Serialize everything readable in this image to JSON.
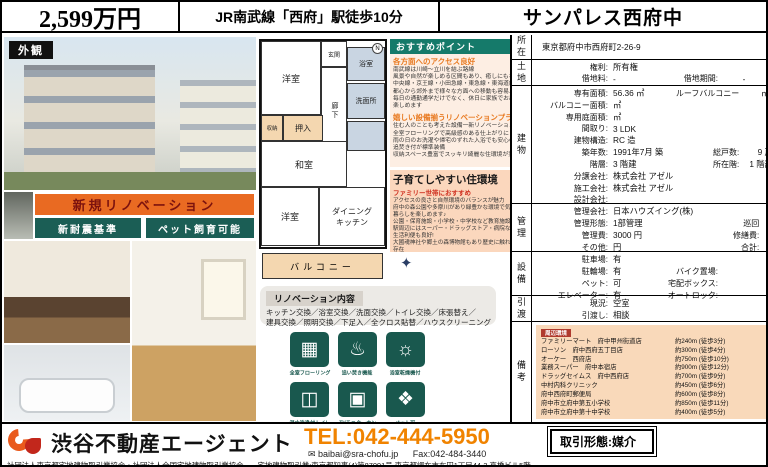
{
  "header": {
    "price": "2,599万円",
    "station": "JR南武線「西府」駅徒歩10分",
    "name": "サンパレス西府中"
  },
  "left": {
    "exterior_label": "外観",
    "banner": "新規リノベーション",
    "btn_seismic": "新耐震基準",
    "btn_pet": "ペット飼育可能"
  },
  "floorplan": {
    "genkan": "玄関",
    "room1": "洋室",
    "bath": "浴室",
    "hall": "廊下",
    "wash": "洗面所",
    "closet": "収納",
    "oshiire": "押入",
    "washitsu": "和室",
    "room2": "洋室",
    "dk1": "ダイニング",
    "dk2": "キッチン",
    "balcony": "バルコニー",
    "north": "N"
  },
  "points": {
    "title": "おすすめポイント",
    "s1_heading": "各方面へのアクセス良好",
    "s1_lines": [
      "南武線は川崎〜立川を結ぶ路線",
      "風景や自然が楽しめる区間もあり、癒しにもなります",
      "中央線・京王線・小田急線・東急線・東海道線と接続しており",
      "都心から郊外まで様々な方面への移動も容易♪",
      "毎日の通勤通学だけでなく、休日に家族でお出かけも",
      "楽しめます"
    ],
    "s2_heading": "嬉しい設備揃うリノベーションプラン",
    "s2_lines": [
      "住む人のことも考えた設備一新リノベーション",
      "全室フローリングで高級感のある仕上がりに",
      "雨の日のお洗濯や帰宅のずれた入浴でも安心の浴室乾燥・",
      "追焚き付が標準装備",
      "収納スペース豊富でスッキリ綺麗な住環境が実現可能"
    ]
  },
  "family": {
    "title": "子育てしやすい住環境",
    "subtitle": "ファミリー世帯におすすめ",
    "lines": [
      "アクセスの良さと自然環境のバランスが魅力",
      "府中の森公園や多摩川があり緑豊かな環境で気持ちの良い",
      "暮らしを楽しめます♪",
      "公園・保育施設・小学校・中学校など教育施設も充実",
      "駅周辺にはスーパー・ドラッグストア・病院などが揃っていて",
      "生活利便も良好!",
      "大國魂神社や郷土の森博物館もあり歴史に触れられるスポット",
      "存在",
      "再開発も進み更に住みやすくなるでしょう♪"
    ]
  },
  "renovation": {
    "title": "リノベーション内容",
    "line1": "キッチン交換／浴室交換／洗面交換／トイレ交換／床張替え／",
    "line2": "建具交換／照明交換／下足入／全クロス貼替／ハウスクリーニング"
  },
  "badges": {
    "items": [
      {
        "icon": "▦",
        "label": "全室フローリング"
      },
      {
        "icon": "♨",
        "label": "追い焚き機能"
      },
      {
        "icon": "☼",
        "label": "浴室乾燥機付"
      },
      {
        "icon": "◫",
        "label": "温水洗浄付トイレ"
      },
      {
        "icon": "▣",
        "label": "TVモニターホン"
      },
      {
        "icon": "❖",
        "label": "ペット可"
      }
    ]
  },
  "property": {
    "loc_tag": "所在",
    "address": "東京都府中市西府町2-26-9",
    "sections": [
      {
        "tag": "土地",
        "rows": [
          {
            "l1": "権利:",
            "v1": "所有権",
            "l2": "",
            "v2": ""
          },
          {
            "l1": "借地料:",
            "v1": "-",
            "l2": "借地期間:",
            "v2": "-"
          }
        ]
      },
      {
        "tag": "建物",
        "rows": [
          {
            "l1": "専有面積:",
            "v1": "56.36 ㎡",
            "l2": "ルーフバルコニー",
            "v2": "㎡"
          },
          {
            "l1": "バルコニー面積:",
            "v1": "㎡",
            "l2": "",
            "v2": ""
          },
          {
            "l1": "専用庭面積:",
            "v1": "㎡",
            "l2": "",
            "v2": ""
          },
          {
            "l1": "間取り:",
            "v1": "3 LDK",
            "l2": "",
            "v2": ""
          },
          {
            "l1": "建物構造:",
            "v1": "RC 造",
            "l2": "",
            "v2": ""
          },
          {
            "l1": "築年数:",
            "v1": "1991年7月 築",
            "l2": "総戸数:",
            "v2": "9 戸"
          },
          {
            "l1": "階層:",
            "v1": "3 階建",
            "l2": "所在階:",
            "v2": "1 階部分"
          },
          {
            "l1": "分譲会社:",
            "v1": "株式会社 アゼル",
            "l2": "",
            "v2": ""
          },
          {
            "l1": "施工会社:",
            "v1": "株式会社 アゼル",
            "l2": "",
            "v2": ""
          },
          {
            "l1": "設計会社:",
            "v1": "",
            "l2": "",
            "v2": ""
          }
        ]
      },
      {
        "tag": "管理",
        "rows": [
          {
            "l1": "管理会社:",
            "v1": "日本ハウズイング(株)",
            "l2": "",
            "v2": ""
          },
          {
            "l1": "管理形態:",
            "v1": "1部管理",
            "l2": "巡回",
            "v2": ""
          },
          {
            "l1": "管理費:",
            "v1": "3000 円",
            "l2": "修繕費:",
            "v2": "5000 円"
          },
          {
            "l1": "その他:",
            "v1": "円",
            "l2": "合計:",
            "v2": "8000 円"
          }
        ]
      },
      {
        "tag": "設備",
        "rows": [
          {
            "l1": "駐車場:",
            "v1": "有",
            "l2": "",
            "v2": ""
          },
          {
            "l1": "駐輪場:",
            "v1": "有",
            "l2": "バイク置場:",
            "v2": ""
          },
          {
            "l1": "ペット:",
            "v1": "可",
            "l2": "宅配ボックス:",
            "v2": ""
          },
          {
            "l1": "エレベーター:",
            "v1": "有",
            "l2": "オートロック:",
            "v2": ""
          }
        ]
      },
      {
        "tag": "引渡",
        "rows": [
          {
            "l1": "現況:",
            "v1": "空室",
            "l2": "",
            "v2": ""
          },
          {
            "l1": "引渡し:",
            "v1": "相談",
            "l2": "",
            "v2": ""
          }
        ]
      }
    ],
    "remarks": {
      "tag": "備考",
      "env_label": "周辺環境",
      "items": [
        {
          "name": "ファミリーマート　府中甲州街道店",
          "dist": "約240m (徒歩3分)"
        },
        {
          "name": "ローソン　府中西府五丁目店",
          "dist": "約300m (徒歩4分)"
        },
        {
          "name": "オーケー　西府店",
          "dist": "約750m (徒歩10分)"
        },
        {
          "name": "業務スーパー　府中本宿店",
          "dist": "約900m (徒歩12分)"
        },
        {
          "name": "ドラッグセイムス　府中西府店",
          "dist": "約700m (徒歩9分)"
        },
        {
          "name": "中村内科クリニック",
          "dist": "約450m (徒歩6分)"
        },
        {
          "name": "府中西府町郵便局",
          "dist": "約600m (徒歩8分)"
        },
        {
          "name": "府中市立府中第五小学校",
          "dist": "約850m (徒歩11分)"
        },
        {
          "name": "府中市立府中第十中学校",
          "dist": "約400m (徒歩5分)"
        }
      ]
    }
  },
  "footer": {
    "company": "渋谷不動産エージェント",
    "tel": "TEL:042-444-5950",
    "email": "baibai@sra-chofu.jp",
    "fax": "Fax:042-484-3440",
    "associations": "社団法人東京都宅地建物取引業協会・社団法人全国宅地建物取引業協会",
    "license": "宅地建物取引業:東京都知事(4)第87091号 東京都調布市布田1丁目44-3 高橋ビル5階",
    "deal_type": "取引形態:媒介"
  }
}
